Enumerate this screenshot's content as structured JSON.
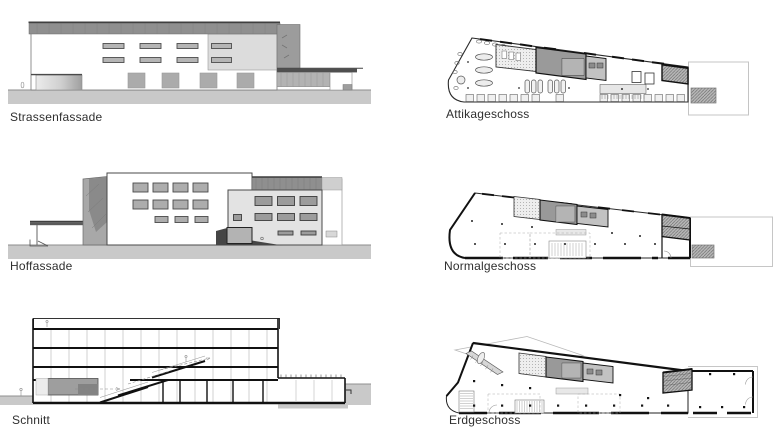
{
  "sheet": {
    "background": "#ffffff"
  },
  "figures": {
    "strassenfassade": {
      "label": "Strassenfassade"
    },
    "hoffassade": {
      "label": "Hoffassade"
    },
    "schnitt": {
      "label": "Schnitt"
    },
    "attikageschoss": {
      "label": "Attikageschoss"
    },
    "normalgeschoss": {
      "label": "Normalgeschoss"
    },
    "erdgeschoss": {
      "label": "Erdgeschoss"
    }
  },
  "colors": {
    "line": "#1a1a1a",
    "label_text": "#2f2f2f",
    "ground": "#c9c9c9",
    "roof_band": "#8f8f8f",
    "light_block": "#dcdcdc",
    "window_fill": "#b3b3b3",
    "core_dark": "#999999",
    "hatch_fill": "#b8b8b8",
    "faint_outline": "#c4c4c4"
  }
}
